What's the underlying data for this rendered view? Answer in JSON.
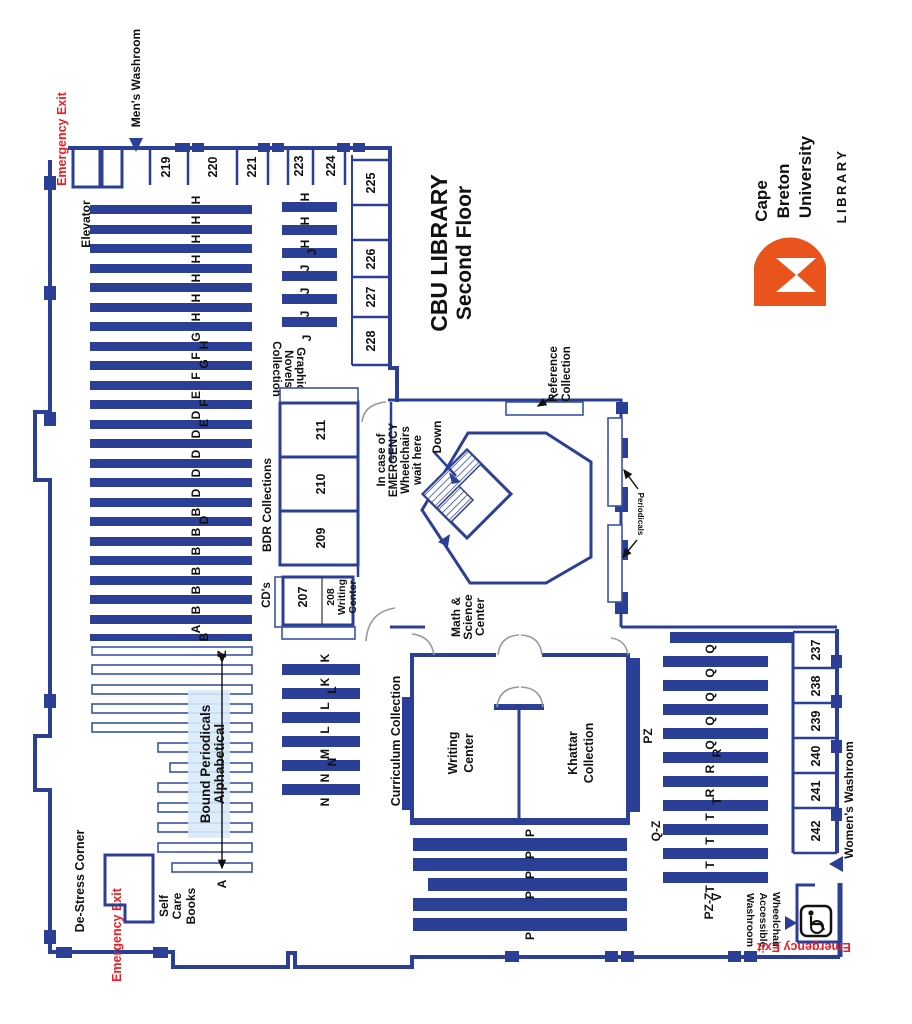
{
  "title": {
    "line1": "CBU LIBRARY",
    "line2": "Second Floor"
  },
  "logo": {
    "line1": "Cape",
    "line2": "Breton",
    "line3": "University",
    "unit": "LIBRARY",
    "orange": "#e8541b",
    "green": "#2e7d4e"
  },
  "exit_label": "Emergency Exit",
  "labels": {
    "mens": "Men's Washroom",
    "womens": "Women's Washroom",
    "elevator": "Elevator",
    "down": "Down",
    "de_stress": "De-Stress Corner",
    "self1": "Self",
    "self2": "Care",
    "self3": "Books",
    "bp1": "Bound Periodicals",
    "bp2": "Alphabetical",
    "bp_a": "A",
    "bp_z": "Z",
    "gn1": "Graphic",
    "gn2": "Novels",
    "gn3": "Collection",
    "bdr": "BDR Collections",
    "cds": "CD's",
    "r208_1": "208",
    "r208_2": "Writing",
    "r208_3": "Center",
    "curriculum": "Curriculum Collection",
    "writing1": "Writing",
    "writing2": "Center",
    "khattar1": "Khattar",
    "khattar2": "Collection",
    "math1": "Math &",
    "math2": "Science",
    "math3": "Center",
    "wait1": "In case of",
    "wait2": "EMERGENCY",
    "wait3": "Wheelchairs",
    "wait4": "wait here",
    "reference1": "Reference",
    "reference2": "Collection",
    "periodicals": "Periodicals",
    "pz": "PZ",
    "qz": "Q-Z",
    "pzz": "PZ-Z",
    "wc1": "Wheelchair",
    "wc2": "Accessible",
    "wc3": "Washroom"
  },
  "rooms": {
    "top": [
      "219",
      "220",
      "221",
      "223",
      "224"
    ],
    "side": [
      "225",
      "226",
      "227",
      "228"
    ],
    "bdr": [
      "211",
      "210",
      "209"
    ],
    "r207": "207",
    "east": [
      "237",
      "238",
      "239",
      "240",
      "241",
      "242"
    ]
  },
  "stacks": {
    "main": [
      "H",
      "H",
      "H",
      "H",
      "H",
      "H",
      "H",
      "G",
      "H",
      "F",
      "G",
      "F",
      "E",
      "F",
      "D",
      "E",
      "D",
      "D",
      "D",
      "D",
      "B",
      "D",
      "B",
      "B",
      "B",
      "B",
      "B",
      "A",
      "B"
    ],
    "j": [
      "H",
      "H",
      "H",
      "J",
      "J",
      "J",
      "J",
      "J"
    ],
    "k": [
      "K",
      "K",
      "L",
      "L",
      "L",
      "M",
      "N",
      "N",
      "N"
    ],
    "q": [
      "Q",
      "Q",
      "Q",
      "Q",
      "Q",
      "R",
      "R",
      "R",
      "T",
      "T",
      "T",
      "T",
      "T",
      "V"
    ],
    "p": [
      "P",
      "P",
      "P",
      "P",
      "P"
    ]
  }
}
